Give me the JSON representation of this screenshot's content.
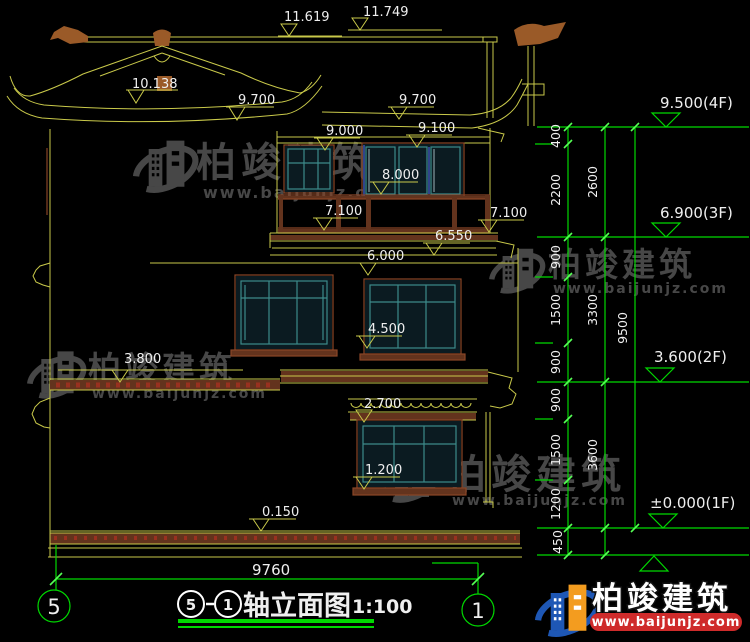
{
  "drawing_title": {
    "axis_from": "5",
    "axis_to": "1",
    "name": "轴立面图",
    "scale": "1:100"
  },
  "axis_bubbles": {
    "left": "5",
    "right": "1"
  },
  "elevation_labels": {
    "e11619": "11.619",
    "e11749": "11.749",
    "e10138": "10.138",
    "e9700_left": "9.700",
    "e9700_right": "9.700",
    "e9000": "9.000",
    "e9100": "9.100",
    "e8000": "8.000",
    "e7100_left": "7.100",
    "e7100_right": "7.100",
    "e6550": "6.550",
    "e6000": "6.000",
    "e4500": "4.500",
    "e3800": "3.800",
    "e2700": "2.700",
    "e1200": "1.200",
    "e0150": "0.150"
  },
  "floor_levels": {
    "f4": "9.500(4F)",
    "f3": "6.900(3F)",
    "f2": "3.600(2F)",
    "f1": "±0.000(1F)"
  },
  "dim_segments": {
    "s400": "400",
    "s2200": "2200",
    "s2600": "2600",
    "s900a": "900",
    "s1500a": "1500",
    "s3300": "3300",
    "s900b": "900",
    "s900c": "900",
    "s1500b": "1500",
    "s3600": "3600",
    "s1200": "1200",
    "s450": "450",
    "s9500": "9500"
  },
  "overall_width": "9760",
  "watermark": {
    "name": "柏竣建筑",
    "url": "www.baijunjz.com"
  },
  "brand": {
    "name": "柏竣建筑",
    "url": "www.baijunjz.com"
  },
  "colors": {
    "outline": "#c9c94a",
    "dim": "#00d900",
    "tick": "#55ff55",
    "white": "#efefef",
    "brown": "#8a4527",
    "brownfill": "#63331d",
    "ornament": "#9a5a28",
    "teal": "#3d8a8a",
    "glass": "#0b1b21",
    "tilered": "#99301f",
    "wm": "#474747",
    "logoblue": "#1e57b5",
    "logoorange": "#f39c1f",
    "urlred": "#cf2b2b"
  }
}
